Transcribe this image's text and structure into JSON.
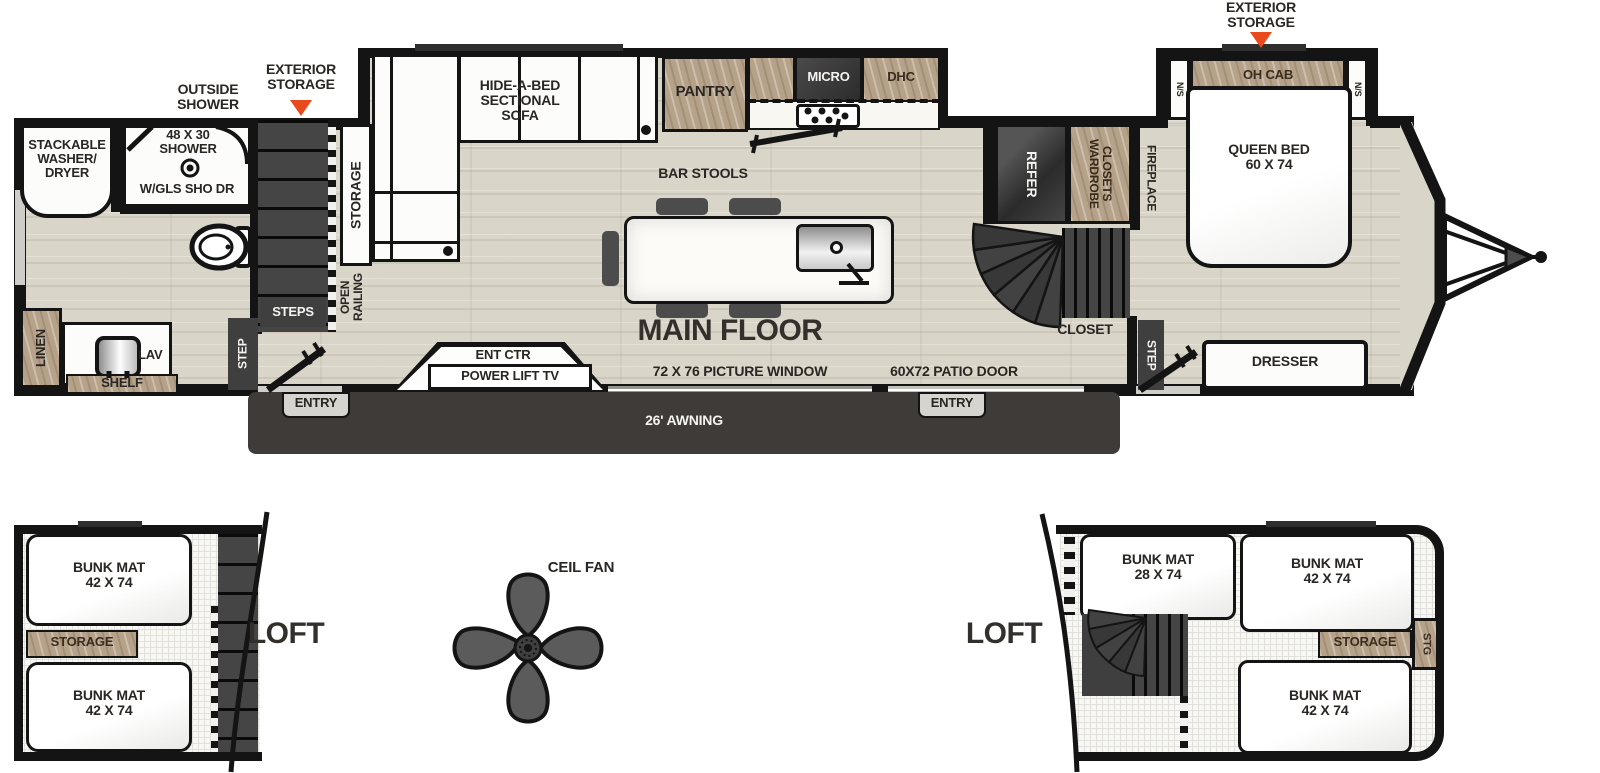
{
  "colors": {
    "floor": "#d9d5c8",
    "wall": "#141414",
    "wood": "#b5a289",
    "dark": "#3f3f3f",
    "accent": "#e8491d",
    "awning": "#3e3b38"
  },
  "main_floor": {
    "title": "MAIN FLOOR",
    "callouts": {
      "outside_shower": "OUTSIDE\nSHOWER",
      "exterior_storage_left": "EXTERIOR\nSTORAGE",
      "exterior_storage_right": "EXTERIOR\nSTORAGE"
    },
    "bath": {
      "washer_dryer": "STACKABLE\nWASHER/\nDRYER",
      "shower_size": "48 X 30\nSHOWER",
      "shower_door": "W/GLS SHO DR",
      "linen": "LINEN",
      "lav": "LAV",
      "shelf": "SHELF"
    },
    "stairwell": {
      "storage": "STORAGE",
      "steps": "STEPS",
      "open_railing": "OPEN\nRAILING",
      "step": "STEP"
    },
    "living": {
      "sofa": "HIDE-A-BED\nSECTIONAL\nSOFA",
      "bar_stools": "BAR STOOLS",
      "ent_ctr": "ENT CTR",
      "power_lift_tv": "POWER LIFT TV",
      "picture_window": "72 X 76 PICTURE WINDOW"
    },
    "kitchen": {
      "pantry": "PANTRY",
      "micro": "MICRO",
      "dhc": "DHC",
      "refer": "REFER",
      "wardrobe_closets": "WARDROBE\nCLOSETS"
    },
    "hall": {
      "patio_door": "60X72 PATIO DOOR",
      "closet": "CLOSET",
      "fireplace": "FIREPLACE",
      "step": "STEP"
    },
    "bedroom": {
      "ns_left": "N/S",
      "oh_cab": "OH CAB",
      "ns_right": "N/S",
      "queen_bed": "QUEEN BED\n60 X 74",
      "dresser": "DRESSER"
    },
    "exterior": {
      "entry_left": "ENTRY",
      "entry_right": "ENTRY",
      "awning": "26' AWNING"
    }
  },
  "loft_left": {
    "title": "LOFT",
    "bunk_top": "BUNK MAT\n42 X 74",
    "storage": "STORAGE",
    "bunk_bottom": "BUNK MAT\n42 X 74"
  },
  "ceiling_fan": {
    "label": "CEIL FAN"
  },
  "loft_right": {
    "title": "LOFT",
    "bunk_left": "BUNK MAT\n28 X 74",
    "bunk_right": "BUNK MAT\n42 X 74",
    "storage": "STORAGE",
    "stg": "STG",
    "bunk_bottom": "BUNK MAT\n42 X 74"
  }
}
